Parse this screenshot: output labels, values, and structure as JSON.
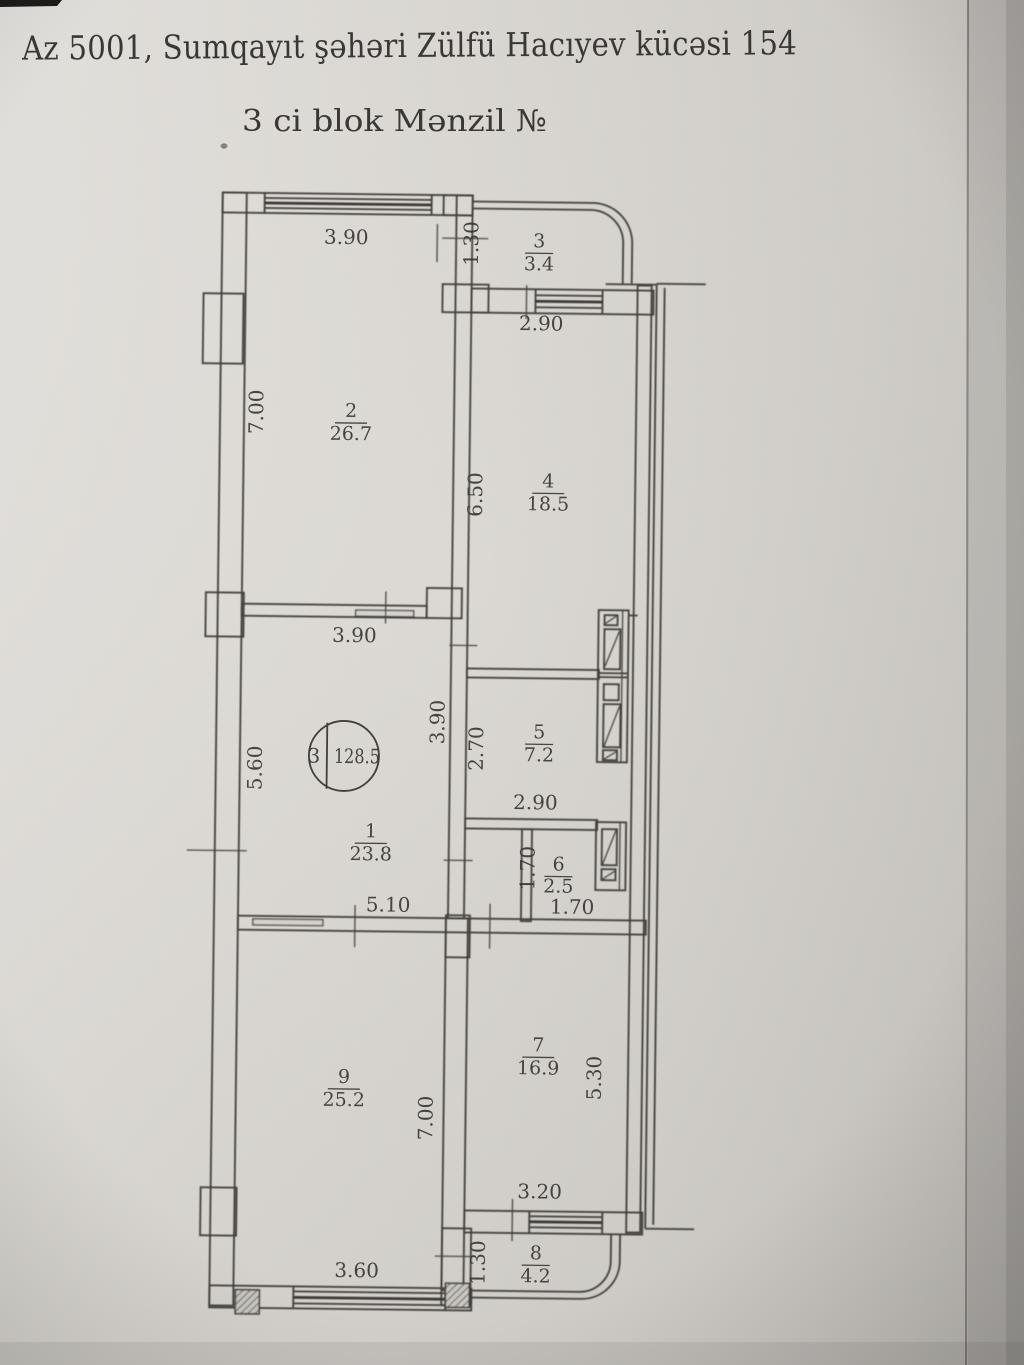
{
  "header": {
    "address_line": "Az 5001, Sumqayıt şəhəri Zülfü Hacıyev kücəsi 154",
    "block_line": "3 ci blok  Mənzil №"
  },
  "unit_badge": {
    "block_number": "3",
    "total_area": "128.5"
  },
  "rooms": [
    {
      "number": "1",
      "area": "23.8"
    },
    {
      "number": "2",
      "area": "26.7"
    },
    {
      "number": "3",
      "area": "3.4"
    },
    {
      "number": "4",
      "area": "18.5"
    },
    {
      "number": "5",
      "area": "7.2"
    },
    {
      "number": "6",
      "area": "2.5"
    },
    {
      "number": "7",
      "area": "16.9"
    },
    {
      "number": "8",
      "area": "4.2"
    },
    {
      "number": "9",
      "area": "25.2"
    }
  ],
  "dimensions": {
    "room2_width": "3.90",
    "balcony3_depth": "1.30",
    "room4_width": "2.90",
    "room2_height": "7.00",
    "room4_height": "6.50",
    "hall_width_top": "3.90",
    "hall_height_left": "5.60",
    "hall_height_mid": "3.90",
    "room5_height": "2.70",
    "room5_width": "2.90",
    "room6_height": "1.70",
    "hall_width_bottom": "5.10",
    "room6_width": "1.70",
    "room9_height": "7.00",
    "room7_height": "5.30",
    "room7_width": "3.20",
    "balcony8_depth": "1.30",
    "room9_width": "3.60"
  },
  "colors": {
    "paper": "#d8d5d0",
    "ink": "#32302c"
  }
}
